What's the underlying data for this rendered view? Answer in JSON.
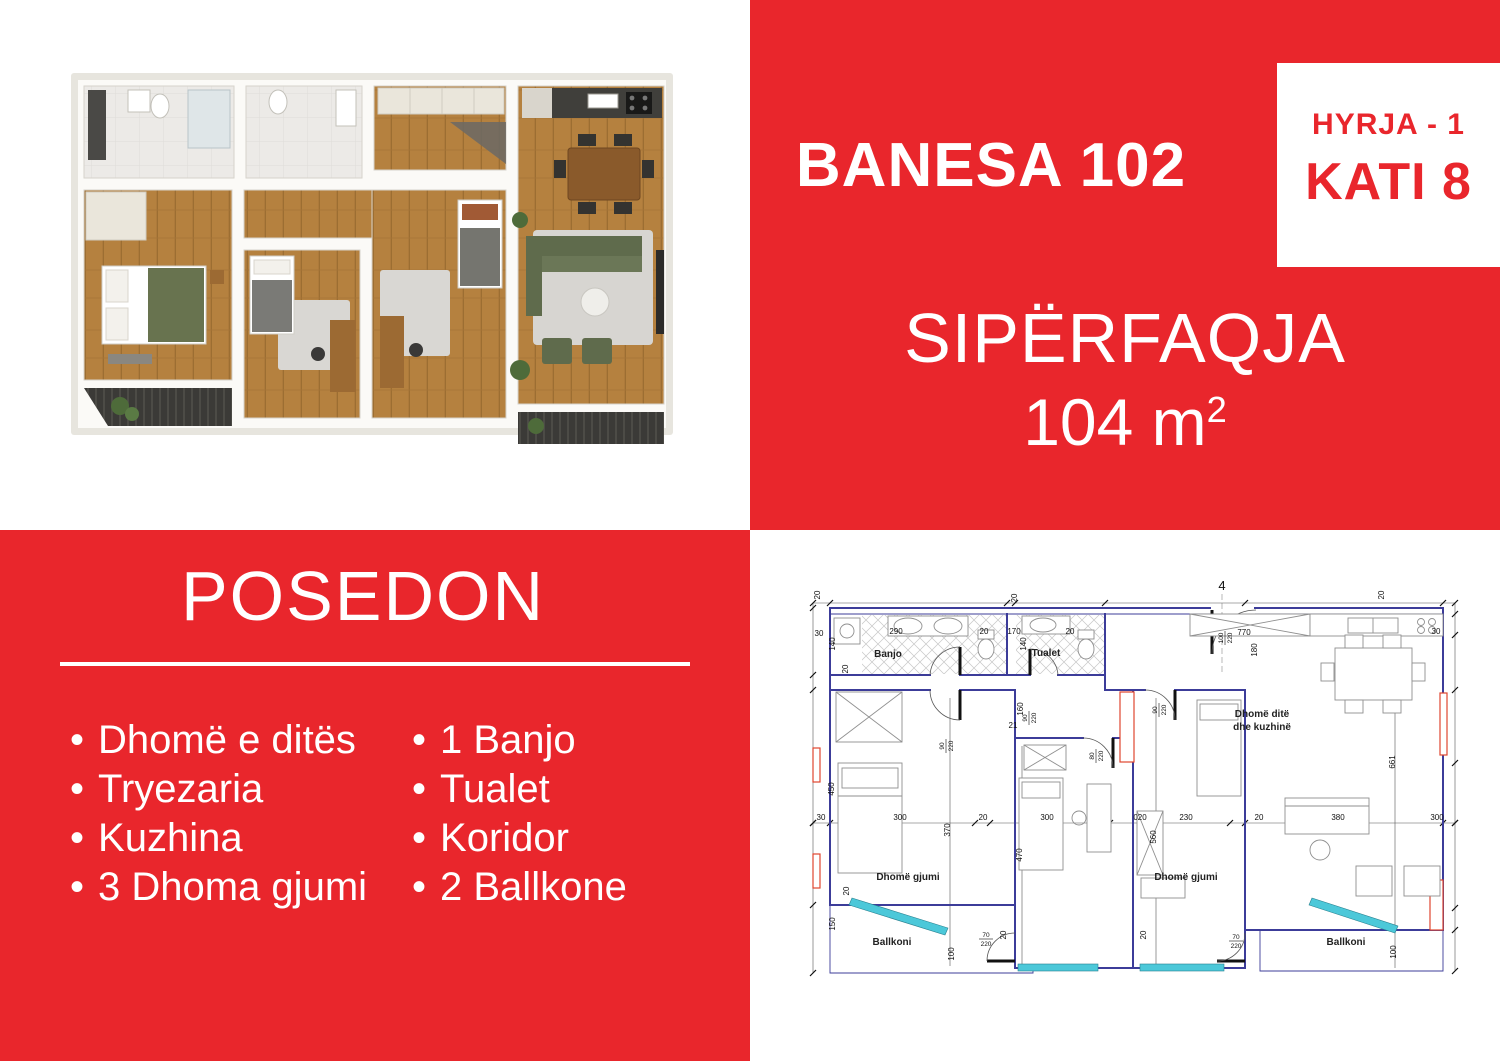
{
  "colors": {
    "panel_red": "#e9262c",
    "plan_wall_navy": "#3c3c99",
    "plan_window_cyan": "#4cc8d9",
    "plan_accent_red": "#e0452f"
  },
  "header": {
    "title": "BANESA 102",
    "entrance_label": "HYRJA - 1",
    "floor_label": "KATI 8",
    "area_title": "SIPËRFAQJA",
    "area_value": "104 m",
    "area_exponent": "2"
  },
  "features": {
    "title": "POSEDON",
    "bullet": "•",
    "column1": [
      "Dhomë e ditës",
      "Tryezaria",
      "Kuzhina",
      "3 Dhoma gjumi"
    ],
    "column2": [
      "1 Banjo",
      "Tualet",
      "Koridor",
      "2 Ballkone"
    ]
  },
  "floor_plan": {
    "labels": [
      {
        "k": "axis",
        "t": "4",
        "x": 422,
        "y": 12
      },
      {
        "k": "room",
        "t": "Banjo",
        "x": 88,
        "y": 79
      },
      {
        "k": "room",
        "t": "Tualet",
        "x": 246,
        "y": 78
      },
      {
        "k": "room",
        "t": "Dhomë ditë",
        "x": 462,
        "y": 139,
        "a": "start"
      },
      {
        "k": "room",
        "t": "dhe kuzhinë",
        "x": 462,
        "y": 152,
        "a": "start"
      },
      {
        "k": "room",
        "t": "Dhomë gjumi",
        "x": 108,
        "y": 302
      },
      {
        "k": "room",
        "t": "Dhomë gjumi",
        "x": 386,
        "y": 302
      },
      {
        "k": "room",
        "t": "Ballkoni",
        "x": 92,
        "y": 367
      },
      {
        "k": "room",
        "t": "Ballkoni",
        "x": 546,
        "y": 367
      },
      {
        "k": "dim",
        "t": "20",
        "x": 20,
        "y": 17,
        "r": 1
      },
      {
        "k": "dim",
        "t": "30",
        "x": 19,
        "y": 58
      },
      {
        "k": "dim",
        "t": "140",
        "x": 35,
        "y": 66,
        "r": 1
      },
      {
        "k": "dim",
        "t": "290",
        "x": 96,
        "y": 56
      },
      {
        "k": "dim",
        "t": "20",
        "x": 184,
        "y": 56
      },
      {
        "k": "dim",
        "t": "170",
        "x": 214,
        "y": 56
      },
      {
        "k": "dim",
        "t": "140",
        "x": 226,
        "y": 66,
        "r": 1
      },
      {
        "k": "dim",
        "t": "20",
        "x": 217,
        "y": 20,
        "r": 1
      },
      {
        "k": "dim",
        "t": "20",
        "x": 270,
        "y": 56
      },
      {
        "k": "dim",
        "t": "770",
        "x": 444,
        "y": 57
      },
      {
        "k": "dim",
        "t": "180",
        "x": 457,
        "y": 72,
        "r": 1
      },
      {
        "k": "dim",
        "t": "20",
        "x": 584,
        "y": 17,
        "r": 1
      },
      {
        "k": "dim",
        "t": "30",
        "x": 636,
        "y": 56
      },
      {
        "k": "dim",
        "t": "20",
        "x": 48,
        "y": 91,
        "r": 1
      },
      {
        "k": "dim",
        "t": "160",
        "x": 223,
        "y": 131,
        "r": 1
      },
      {
        "k": "dim",
        "t": "21",
        "x": 213,
        "y": 150
      },
      {
        "k": "dim",
        "t": "450",
        "x": 34,
        "y": 211,
        "r": 1
      },
      {
        "k": "dim",
        "t": "20",
        "x": 49,
        "y": 313,
        "r": 1
      },
      {
        "k": "dim",
        "t": "150",
        "x": 35,
        "y": 346,
        "r": 1
      },
      {
        "k": "dim",
        "t": "370",
        "x": 150,
        "y": 252,
        "r": 1
      },
      {
        "k": "dim",
        "t": "470",
        "x": 222,
        "y": 277,
        "r": 1
      },
      {
        "k": "dim",
        "t": "560",
        "x": 356,
        "y": 259,
        "r": 1
      },
      {
        "k": "dim",
        "t": "661",
        "x": 595,
        "y": 184,
        "r": 1
      },
      {
        "k": "dim",
        "t": "100",
        "x": 154,
        "y": 376,
        "r": 1
      },
      {
        "k": "dim",
        "t": "100",
        "x": 596,
        "y": 374,
        "r": 1
      },
      {
        "k": "dim",
        "t": "20",
        "x": 206,
        "y": 357,
        "r": 1
      },
      {
        "k": "dim",
        "t": "20",
        "x": 346,
        "y": 357,
        "r": 1
      },
      {
        "k": "dim",
        "t": "30",
        "x": 21,
        "y": 242
      },
      {
        "k": "dim",
        "t": "300",
        "x": 100,
        "y": 242
      },
      {
        "k": "dim",
        "t": "20",
        "x": 183,
        "y": 242
      },
      {
        "k": "dim",
        "t": "300",
        "x": 247,
        "y": 242
      },
      {
        "k": "dim",
        "t": "020",
        "x": 340,
        "y": 242
      },
      {
        "k": "dim",
        "t": "230",
        "x": 386,
        "y": 242
      },
      {
        "k": "dim",
        "t": "20",
        "x": 459,
        "y": 242
      },
      {
        "k": "dim",
        "t": "380",
        "x": 538,
        "y": 242
      },
      {
        "k": "dim",
        "t": "300",
        "x": 637,
        "y": 242
      },
      {
        "k": "door",
        "t": "90/220",
        "x": 145,
        "y": 168,
        "r": 1
      },
      {
        "k": "door",
        "t": "90/220",
        "x": 228,
        "y": 140,
        "r": 1
      },
      {
        "k": "door",
        "t": "80/220",
        "x": 295,
        "y": 178,
        "r": 1
      },
      {
        "k": "door",
        "t": "90/220",
        "x": 358,
        "y": 132,
        "r": 1
      },
      {
        "k": "door",
        "t": "100/220",
        "x": 424,
        "y": 60,
        "r": 1
      },
      {
        "k": "door",
        "t": "70/220",
        "x": 186,
        "y": 360
      },
      {
        "k": "door",
        "t": "70/220",
        "x": 436,
        "y": 362
      }
    ]
  }
}
